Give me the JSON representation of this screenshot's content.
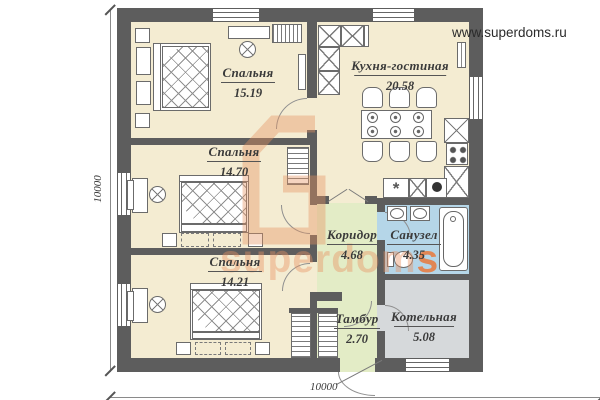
{
  "header": {
    "url": "www.superdoms.ru"
  },
  "watermark": {
    "brand_main": "superdom",
    "brand_accent": "s"
  },
  "dimensions": {
    "left": "10000",
    "bottom": "10000"
  },
  "rooms": [
    {
      "name": "Спальня",
      "area": "15.19"
    },
    {
      "name": "Кухня-гостиная",
      "area": "20.58"
    },
    {
      "name": "Спальня",
      "area": "14.70"
    },
    {
      "name": "Спальня",
      "area": "14.21"
    },
    {
      "name": "Коридор",
      "area": "4.68"
    },
    {
      "name": "Санузел",
      "area": "4.35"
    },
    {
      "name": "Тамбур",
      "area": "2.70"
    },
    {
      "name": "Котельная",
      "area": "5.08"
    }
  ],
  "colors": {
    "wall": "#5d5d5d",
    "room_floor": "#f4ecd2",
    "hall_floor": "#e3ecc6",
    "bath_floor": "#b5d6e8",
    "utility_floor": "#d6d9db",
    "watermark_accent": "#e8946a"
  }
}
